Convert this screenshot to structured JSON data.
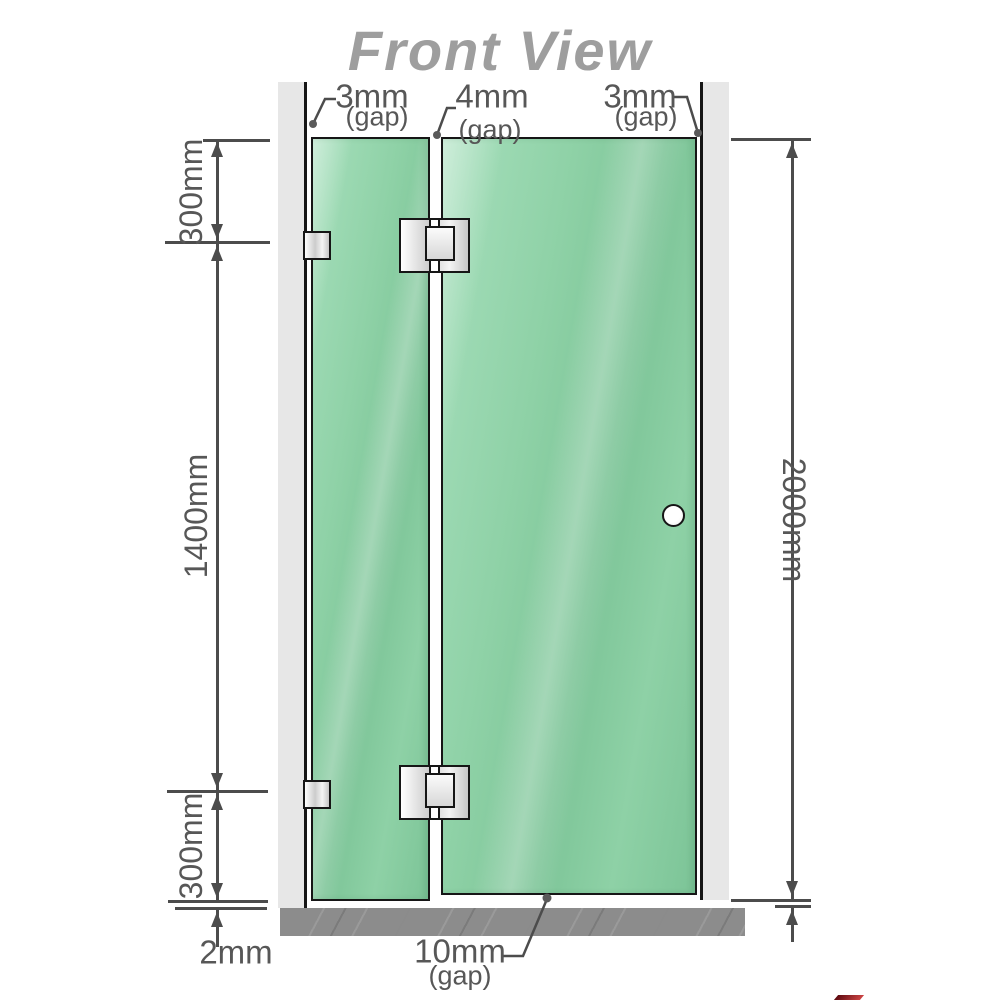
{
  "title": "Front View",
  "dimensions": {
    "top_segment": "300mm",
    "middle_segment": "1400mm",
    "bottom_segment": "300mm",
    "total_height": "2000mm",
    "floor_clearance": "2mm"
  },
  "gaps": {
    "left": {
      "value": "3mm",
      "note": "(gap)"
    },
    "middle": {
      "value": "4mm",
      "note": "(gap)"
    },
    "right": {
      "value": "3mm",
      "note": "(gap)"
    },
    "bottom": {
      "value": "10mm",
      "note": "(gap)"
    }
  },
  "colors": {
    "glass": "#8ed1a6",
    "glass-dark": "#7cc497",
    "glass-light": "#a6dfbc",
    "wall": "#e7e7e7",
    "floor": "#8c8c8c",
    "line": "#4c4c4c",
    "text": "#575757",
    "title": "#9e9e9e",
    "outline": "#161616"
  }
}
